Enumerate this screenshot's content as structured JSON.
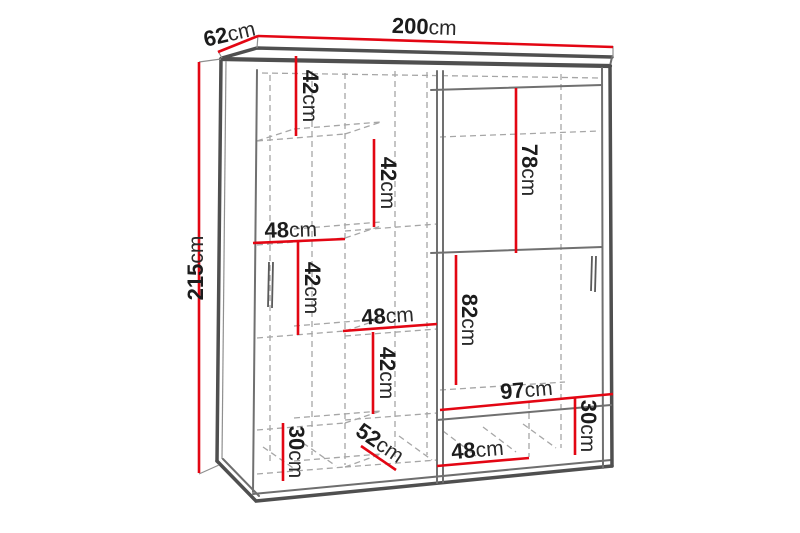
{
  "diagram": {
    "title": "Sliding-door wardrobe dimension diagram",
    "unit": "cm",
    "colors": {
      "dimension_line": "#e30613",
      "cabinet_outline": "#4f4f4f",
      "interior_dashed": "#a6a6a6",
      "label_text": "#1c1c1c",
      "background": "#ffffff"
    },
    "dims": {
      "total_width": {
        "value": "200",
        "unit": "cm"
      },
      "total_depth": {
        "value": "62",
        "unit": "cm"
      },
      "total_height": {
        "value": "215",
        "unit": "cm"
      },
      "top_left_shelf_height": {
        "value": "42",
        "unit": "cm"
      },
      "upper_mid_shelf_height": {
        "value": "42",
        "unit": "cm"
      },
      "left_shelf_width": {
        "value": "48",
        "unit": "cm"
      },
      "mid_left_shelf_height": {
        "value": "42",
        "unit": "cm"
      },
      "mid_shelf_width": {
        "value": "48",
        "unit": "cm"
      },
      "lower_mid_shelf_height": {
        "value": "42",
        "unit": "cm"
      },
      "right_upper_section_height": {
        "value": "78",
        "unit": "cm"
      },
      "right_lower_section_height": {
        "value": "82",
        "unit": "cm"
      },
      "right_section_width": {
        "value": "97",
        "unit": "cm"
      },
      "bottom_right_shelf_height": {
        "value": "30",
        "unit": "cm"
      },
      "bottom_shelf_width": {
        "value": "48",
        "unit": "cm"
      },
      "bottom_left_shelf_height": {
        "value": "30",
        "unit": "cm"
      },
      "interior_depth": {
        "value": "52",
        "unit": "cm"
      }
    }
  }
}
